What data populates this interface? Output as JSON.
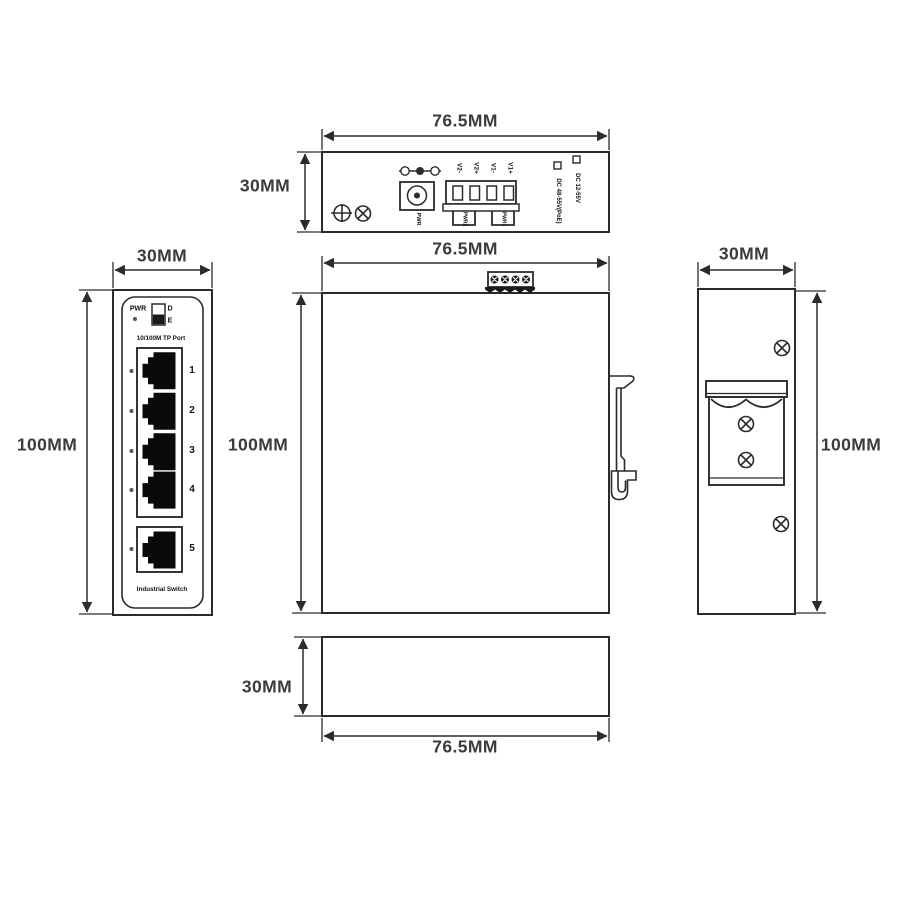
{
  "title": "Industrial Switch Dimension Drawing",
  "colors": {
    "line": "#2b2b2b",
    "text": "#3b3b3b",
    "bg": "#ffffff"
  },
  "views": {
    "top": {
      "width_label": "76.5MM",
      "height_label": "30MM",
      "jack_label": "PWR",
      "terminal_pins": [
        "V2-",
        "V2+",
        "V1-",
        "V1+"
      ],
      "clamp_labels": [
        "PWR2",
        "PWR1"
      ],
      "power_options": [
        "DC 12-55V",
        "DC 48-55V(PoE)"
      ]
    },
    "front": {
      "width_label": "30MM",
      "height_label": "100MM",
      "power_led_label": "PWR",
      "dip_top_label": "D",
      "dip_bottom_label": "E",
      "ports_title": "10/100M TP Port",
      "port_numbers": [
        "1",
        "2",
        "3",
        "4",
        "5"
      ],
      "footer_label": "Industrial Switch"
    },
    "side": {
      "width_label": "76.5MM",
      "height_label": "100MM"
    },
    "right_side": {
      "width_label": "30MM",
      "height_label": "100MM"
    },
    "bottom": {
      "width_label": "76.5MM",
      "height_label": "30MM"
    }
  }
}
